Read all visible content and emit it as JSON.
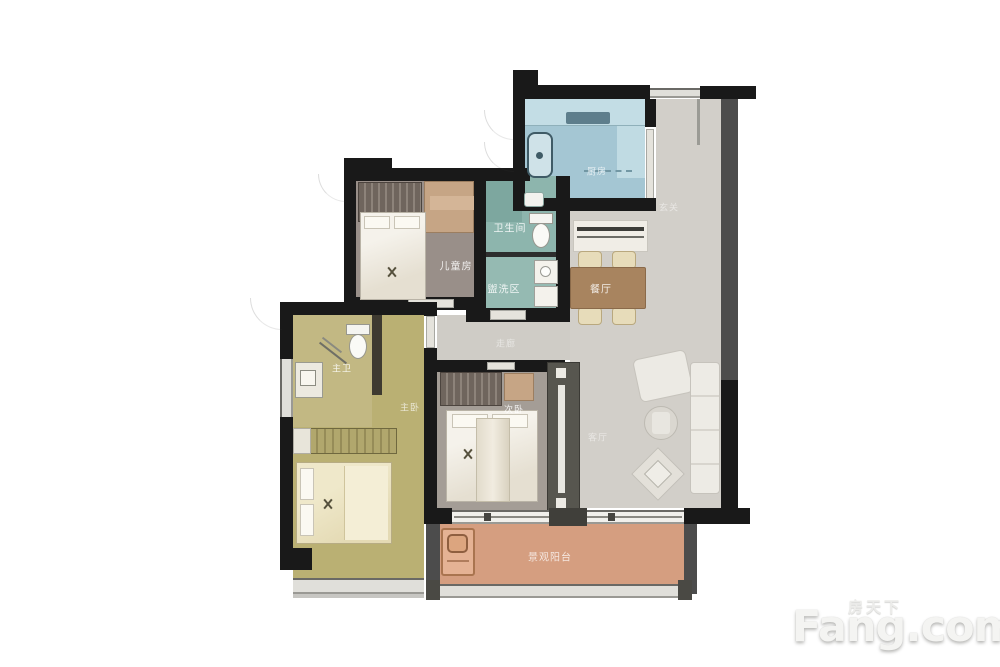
{
  "rooms": [
    {
      "id": "kitchen",
      "label": "厨房"
    },
    {
      "id": "bathroom",
      "label": "卫生间"
    },
    {
      "id": "wash-area",
      "label": "盥洗区"
    },
    {
      "id": "kids-room",
      "label": "儿童房"
    },
    {
      "id": "dining-room",
      "label": "餐厅"
    },
    {
      "id": "foyer",
      "label": "玄关"
    },
    {
      "id": "corridor",
      "label": "走廊"
    },
    {
      "id": "master-bathroom",
      "label": "主卫"
    },
    {
      "id": "master-bedroom",
      "label": "主卧"
    },
    {
      "id": "second-bedroom",
      "label": "次卧"
    },
    {
      "id": "living-room",
      "label": "客厅"
    },
    {
      "id": "balcony",
      "label": "景观阳台"
    }
  ],
  "watermark": {
    "site_cn": "房天下",
    "site_en": "Fang.com"
  },
  "palette": {
    "wall": "#191919",
    "gray_wall": "#4c4c4c",
    "kitchen_floor": "#a4c6d3",
    "bathroom_floor": "#8db5ad",
    "wash_floor": "#95bab2",
    "kids_floor": "#998f89",
    "living_floor": "#d2cfc9",
    "master_floor": "#bab073",
    "master_bath_floor": "#c2b883",
    "second_bedroom_floor": "#a49d96",
    "balcony_floor": "#d59e80",
    "dining_table": "#a8845f"
  }
}
